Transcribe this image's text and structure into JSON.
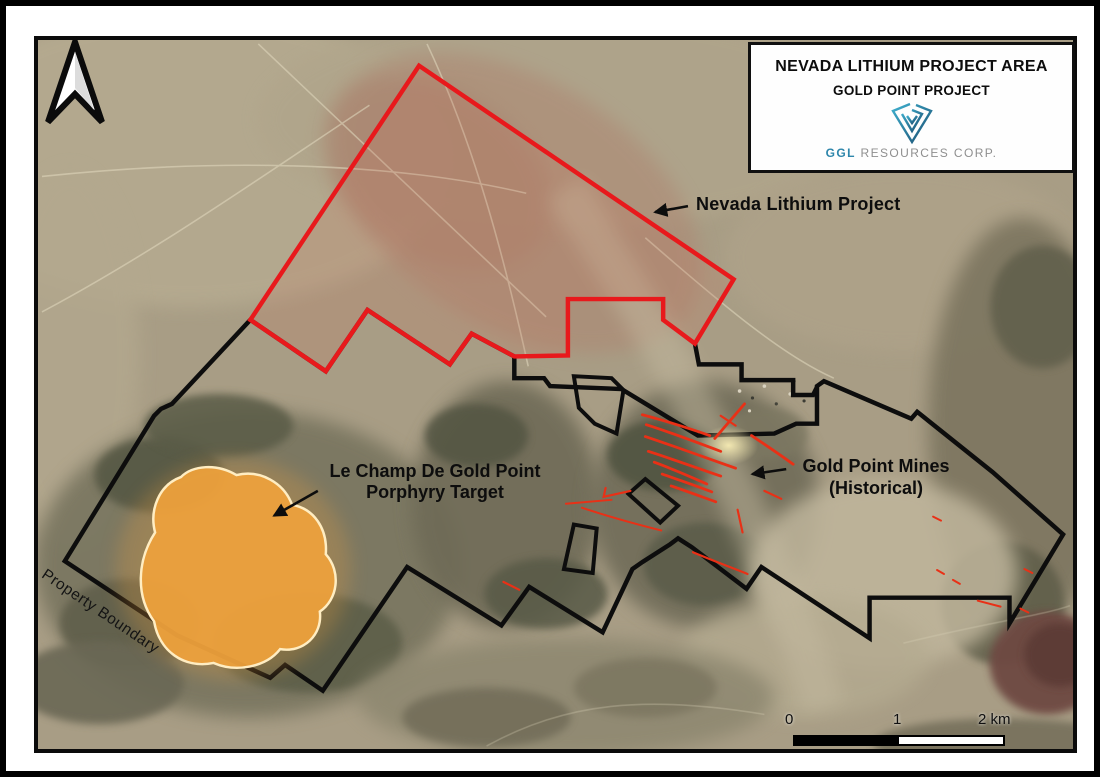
{
  "title_box": {
    "line1": "NEVADA LITHIUM PROJECT AREA",
    "line2": "GOLD POINT PROJECT",
    "company_bold": "GGL",
    "company_rest": " RESOURCES CORP."
  },
  "annotations": {
    "lithium_label": "Nevada Lithium Project",
    "porphyry_label_line1": "Le Champ De Gold Point",
    "porphyry_label_line2": "Porphyry Target",
    "mines_label_line1": "Gold Point Mines",
    "mines_label_line2": "(Historical)",
    "boundary_label": "Property Boundary"
  },
  "scale_bar": {
    "start": "0",
    "mid": "1",
    "end": "2 km"
  },
  "colors": {
    "lithium_boundary": "#e8191c",
    "property_boundary": "#0d0d0d",
    "porphyry_fill": "#f0a23c",
    "porphyry_outline": "#ffedc2",
    "vein": "#e93016",
    "annotation_text": "#0d0d0d",
    "logo_light": "#3fb0cf",
    "logo_dark": "#1b4f72",
    "company_bold_color": "#2e86ab",
    "company_rest_color": "#8f8f8f"
  }
}
